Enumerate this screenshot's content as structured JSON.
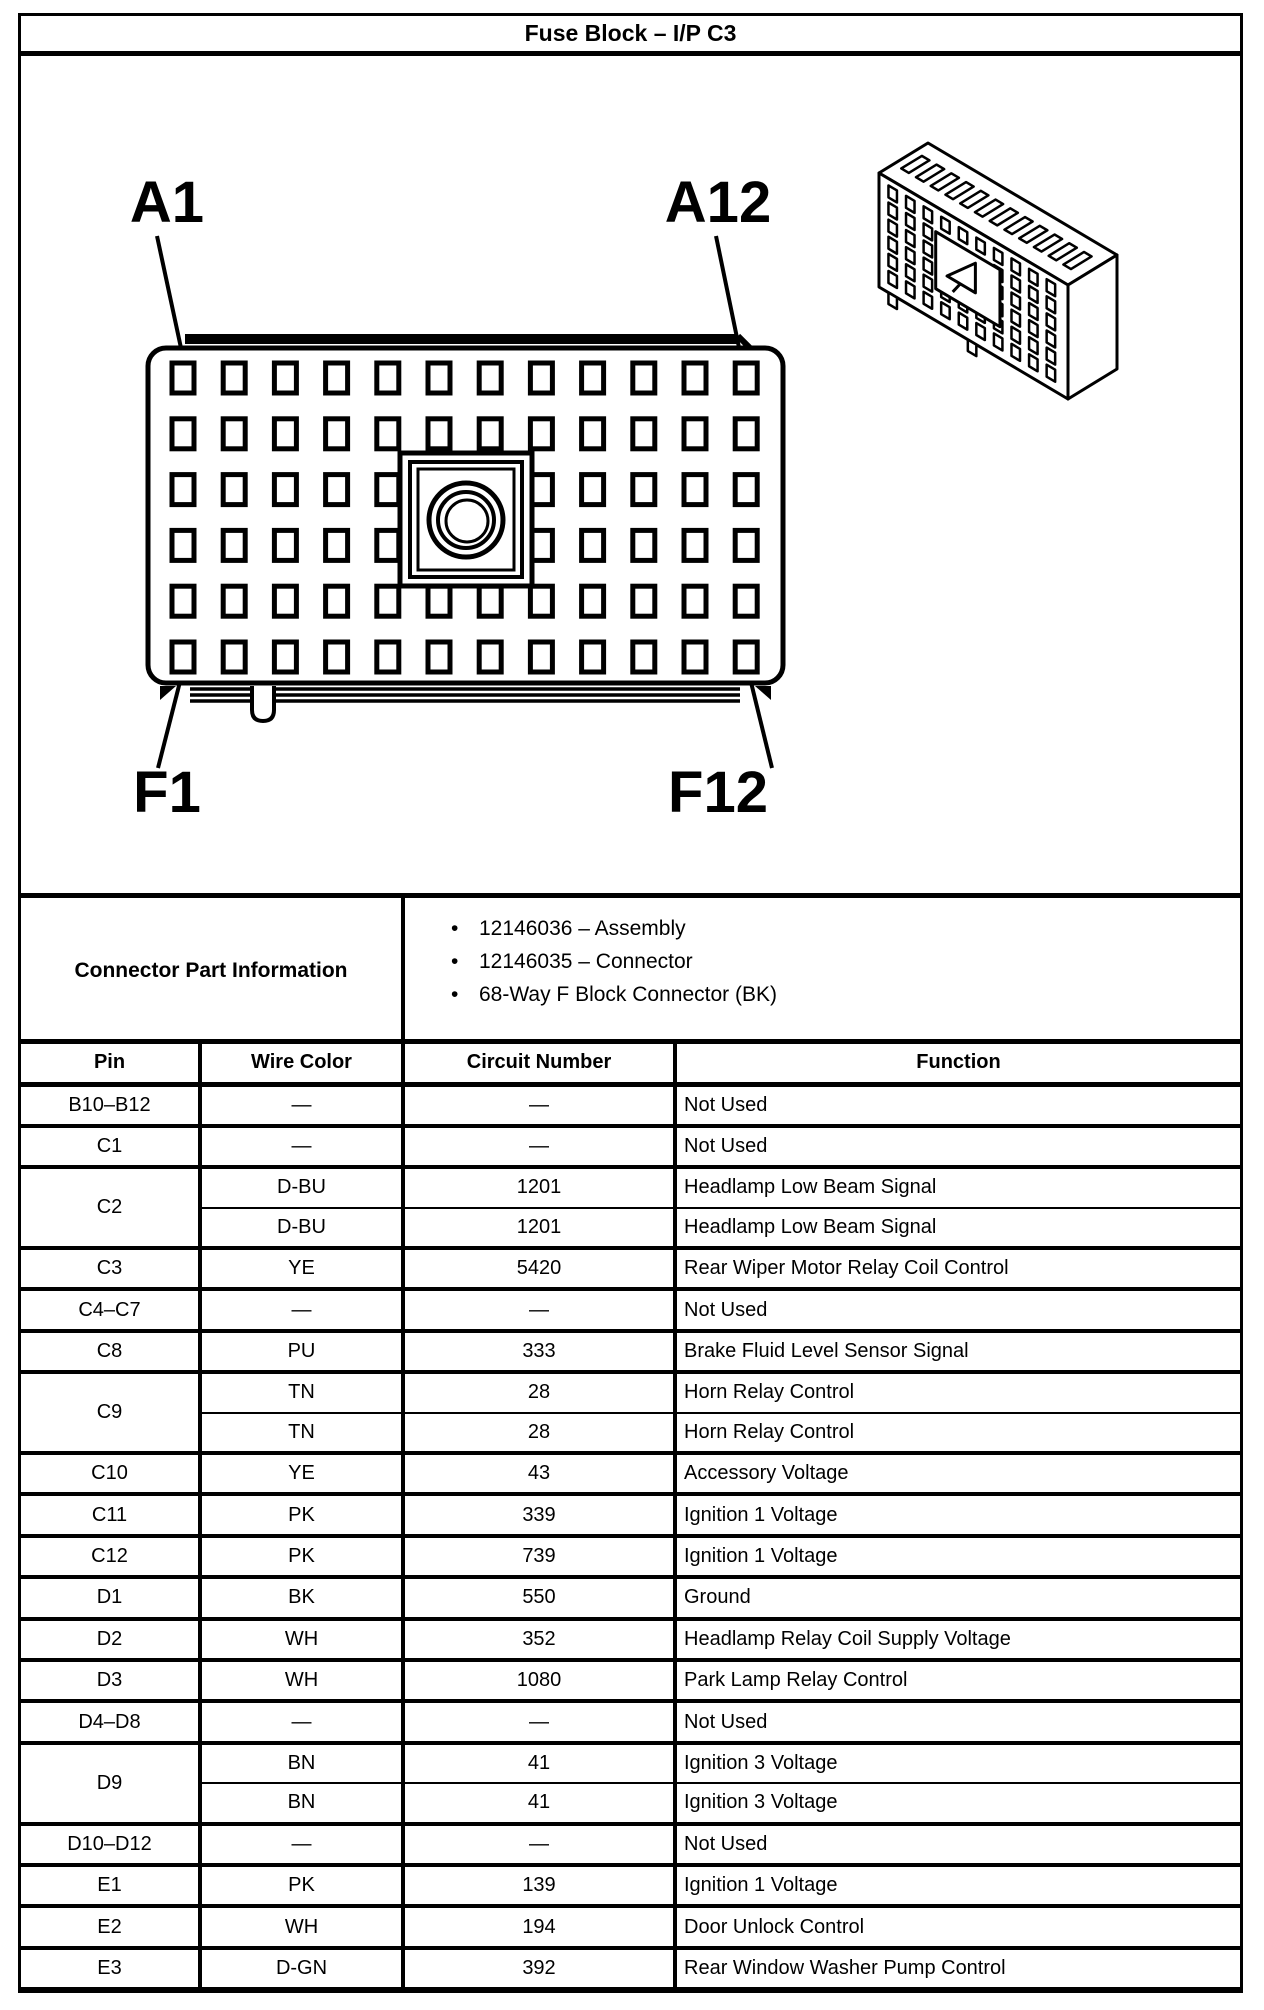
{
  "title": "Fuse Block – I/P C3",
  "diagram": {
    "pin_labels": {
      "top_left": "A1",
      "top_right": "A12",
      "bottom_left": "F1",
      "bottom_right": "F12"
    }
  },
  "connector_part_information": {
    "label": "Connector Part Information",
    "items": [
      "12146036 – Assembly",
      "12146035 – Connector",
      "68-Way F Block Connector (BK)"
    ]
  },
  "table": {
    "headers": [
      "Pin",
      "Wire Color",
      "Circuit Number",
      "Function"
    ],
    "rows": [
      {
        "pin": "B10–B12",
        "entries": [
          {
            "wire_color": "—",
            "circuit_number": "—",
            "function": "Not Used"
          }
        ]
      },
      {
        "pin": "C1",
        "entries": [
          {
            "wire_color": "—",
            "circuit_number": "—",
            "function": "Not Used"
          }
        ]
      },
      {
        "pin": "C2",
        "entries": [
          {
            "wire_color": "D-BU",
            "circuit_number": "1201",
            "function": "Headlamp Low Beam Signal"
          },
          {
            "wire_color": "D-BU",
            "circuit_number": "1201",
            "function": "Headlamp Low Beam Signal"
          }
        ]
      },
      {
        "pin": "C3",
        "entries": [
          {
            "wire_color": "YE",
            "circuit_number": "5420",
            "function": "Rear Wiper Motor Relay Coil Control"
          }
        ]
      },
      {
        "pin": "C4–C7",
        "entries": [
          {
            "wire_color": "—",
            "circuit_number": "—",
            "function": "Not Used"
          }
        ]
      },
      {
        "pin": "C8",
        "entries": [
          {
            "wire_color": "PU",
            "circuit_number": "333",
            "function": "Brake Fluid Level Sensor Signal"
          }
        ]
      },
      {
        "pin": "C9",
        "entries": [
          {
            "wire_color": "TN",
            "circuit_number": "28",
            "function": "Horn Relay Control"
          },
          {
            "wire_color": "TN",
            "circuit_number": "28",
            "function": "Horn Relay Control"
          }
        ]
      },
      {
        "pin": "C10",
        "entries": [
          {
            "wire_color": "YE",
            "circuit_number": "43",
            "function": "Accessory Voltage"
          }
        ]
      },
      {
        "pin": "C11",
        "entries": [
          {
            "wire_color": "PK",
            "circuit_number": "339",
            "function": "Ignition 1 Voltage"
          }
        ]
      },
      {
        "pin": "C12",
        "entries": [
          {
            "wire_color": "PK",
            "circuit_number": "739",
            "function": "Ignition 1 Voltage"
          }
        ]
      },
      {
        "pin": "D1",
        "entries": [
          {
            "wire_color": "BK",
            "circuit_number": "550",
            "function": "Ground"
          }
        ]
      },
      {
        "pin": "D2",
        "entries": [
          {
            "wire_color": "WH",
            "circuit_number": "352",
            "function": "Headlamp Relay Coil Supply Voltage"
          }
        ]
      },
      {
        "pin": "D3",
        "entries": [
          {
            "wire_color": "WH",
            "circuit_number": "1080",
            "function": "Park Lamp Relay Control"
          }
        ]
      },
      {
        "pin": "D4–D8",
        "entries": [
          {
            "wire_color": "—",
            "circuit_number": "—",
            "function": "Not Used"
          }
        ]
      },
      {
        "pin": "D9",
        "entries": [
          {
            "wire_color": "BN",
            "circuit_number": "41",
            "function": "Ignition 3 Voltage"
          },
          {
            "wire_color": "BN",
            "circuit_number": "41",
            "function": "Ignition 3 Voltage"
          }
        ]
      },
      {
        "pin": "D10–D12",
        "entries": [
          {
            "wire_color": "—",
            "circuit_number": "—",
            "function": "Not Used"
          }
        ]
      },
      {
        "pin": "E1",
        "entries": [
          {
            "wire_color": "PK",
            "circuit_number": "139",
            "function": "Ignition 1 Voltage"
          }
        ]
      },
      {
        "pin": "E2",
        "entries": [
          {
            "wire_color": "WH",
            "circuit_number": "194",
            "function": "Door Unlock Control"
          }
        ]
      },
      {
        "pin": "E3",
        "entries": [
          {
            "wire_color": "D-GN",
            "circuit_number": "392",
            "function": "Rear Window Washer Pump Control"
          }
        ]
      }
    ]
  },
  "colors": {
    "ink": "#000000",
    "paper": "#ffffff"
  }
}
